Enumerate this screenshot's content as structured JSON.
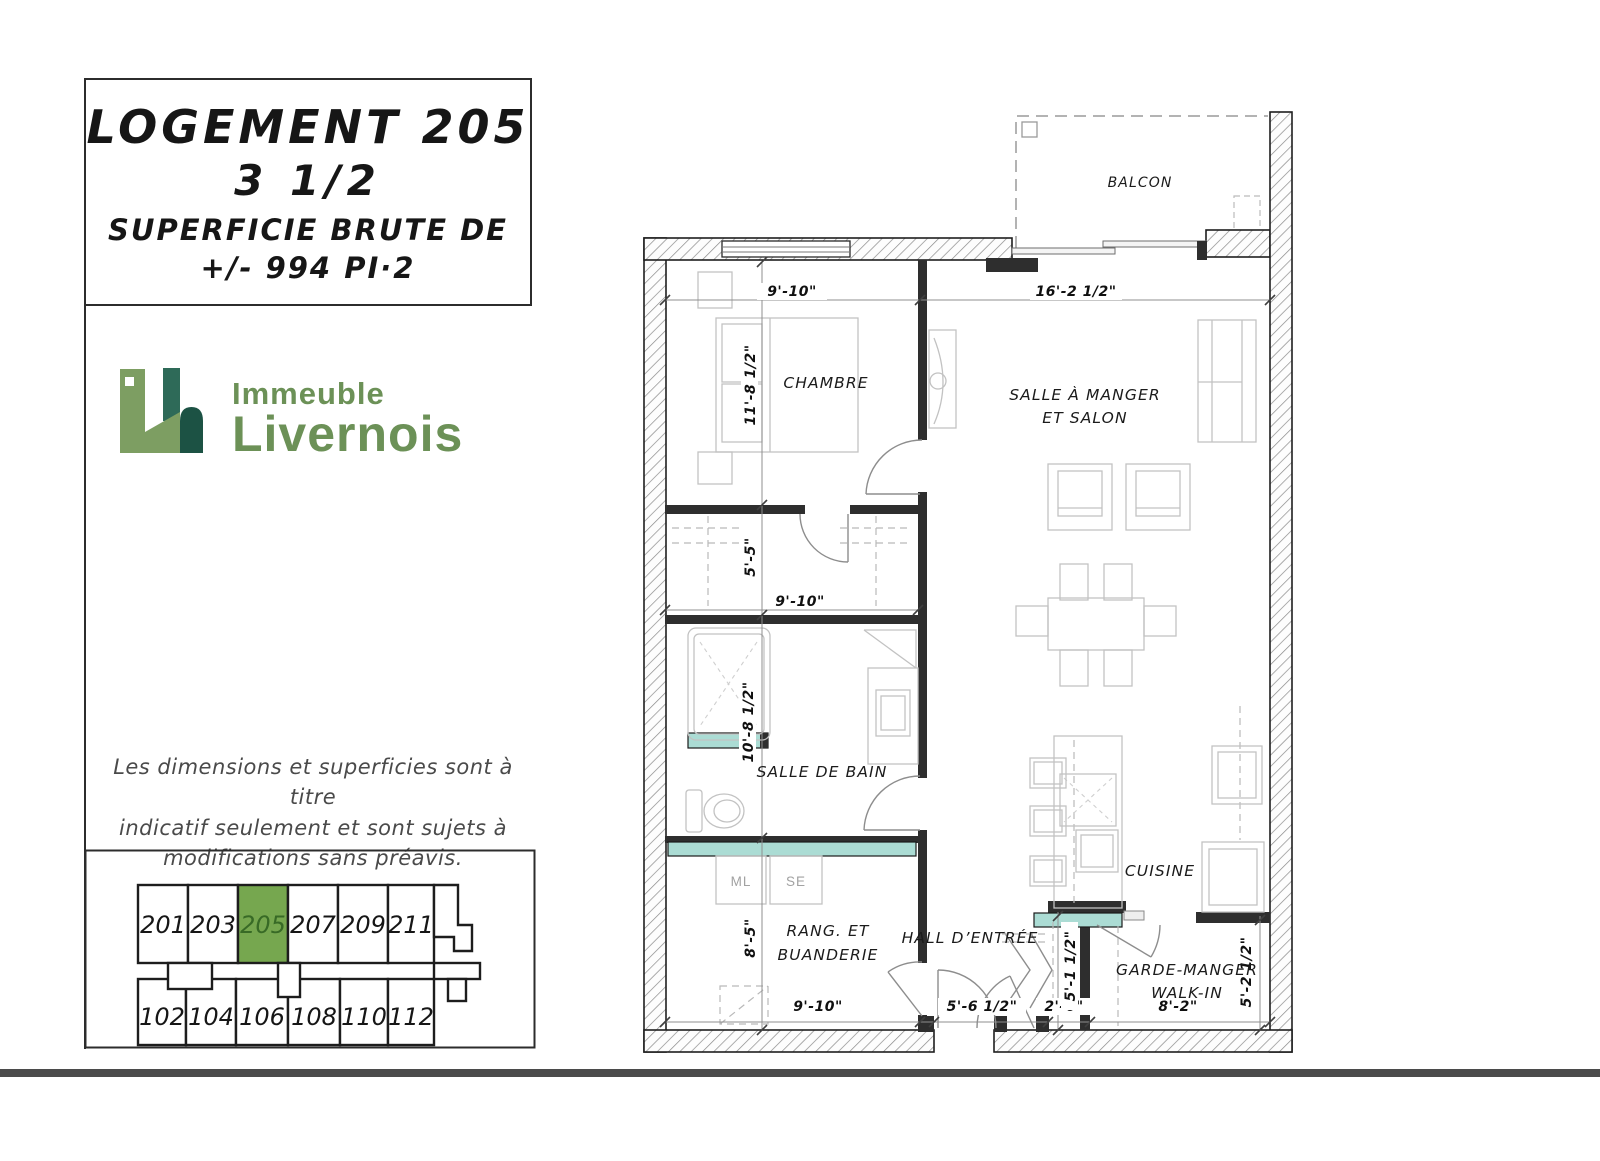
{
  "title_block": {
    "unit": "LOGEMENT 205",
    "type": "3 1/2",
    "area_label": "SUPERFICIE BRUTE DE",
    "area_value": "+/- 994 PI·2"
  },
  "logo": {
    "top": "Immeuble",
    "bottom": "Livernois"
  },
  "disclaimer": {
    "line1": "Les dimensions et superficies sont à titre",
    "line2": "indicatif seulement et sont sujets à",
    "line3": "modifications sans préavis."
  },
  "building_map": {
    "highlighted_unit": "205",
    "upper_units": [
      "201",
      "203",
      "205",
      "207",
      "209",
      "211"
    ],
    "lower_units": [
      "102",
      "104",
      "106",
      "108",
      "110",
      "112"
    ]
  },
  "plan": {
    "rooms": {
      "balcony": "BALCON",
      "bedroom": "CHAMBRE",
      "living_line1": "SALLE À MANGER",
      "living_line2": "ET SALON",
      "bathroom": "SALLE DE BAIN",
      "laundry_line1": "RANG. ET",
      "laundry_line2": "BUANDERIE",
      "hall": "HALL D’ENTRÉE",
      "kitchen": "CUISINE",
      "pantry_line1": "GARDE-MANGER",
      "pantry_line2": "WALK-IN",
      "washer": "ML",
      "dryer": "SE"
    },
    "dims": {
      "bedroom_width": "9'-10\"",
      "living_width": "16'-2 1/2\"",
      "bedroom_depth": "11'-8 1/2\"",
      "closet_depth": "5'-5\"",
      "closet_width": "9'-10\"",
      "bathroom_depth": "10'-8 1/2\"",
      "laundry_depth": "8'-5\"",
      "laundry_width": "9'-10\"",
      "hall_width": "5'-6 1/2\"",
      "closet_hall_width": "2'-6\"",
      "hall_depth": "5'-1 1/2\"",
      "pantry_width": "8'-2\"",
      "pantry_depth": "5'-2 1/2\""
    }
  },
  "colors": {
    "accent_green": "#76a74f",
    "accent_green_dark": "#386a26",
    "counter_teal": "#abdcd4",
    "logo_light": "#7d9e62",
    "logo_mid": "#2e6a58",
    "logo_dark": "#1c5244",
    "logo_text_green": "#6c9157"
  }
}
